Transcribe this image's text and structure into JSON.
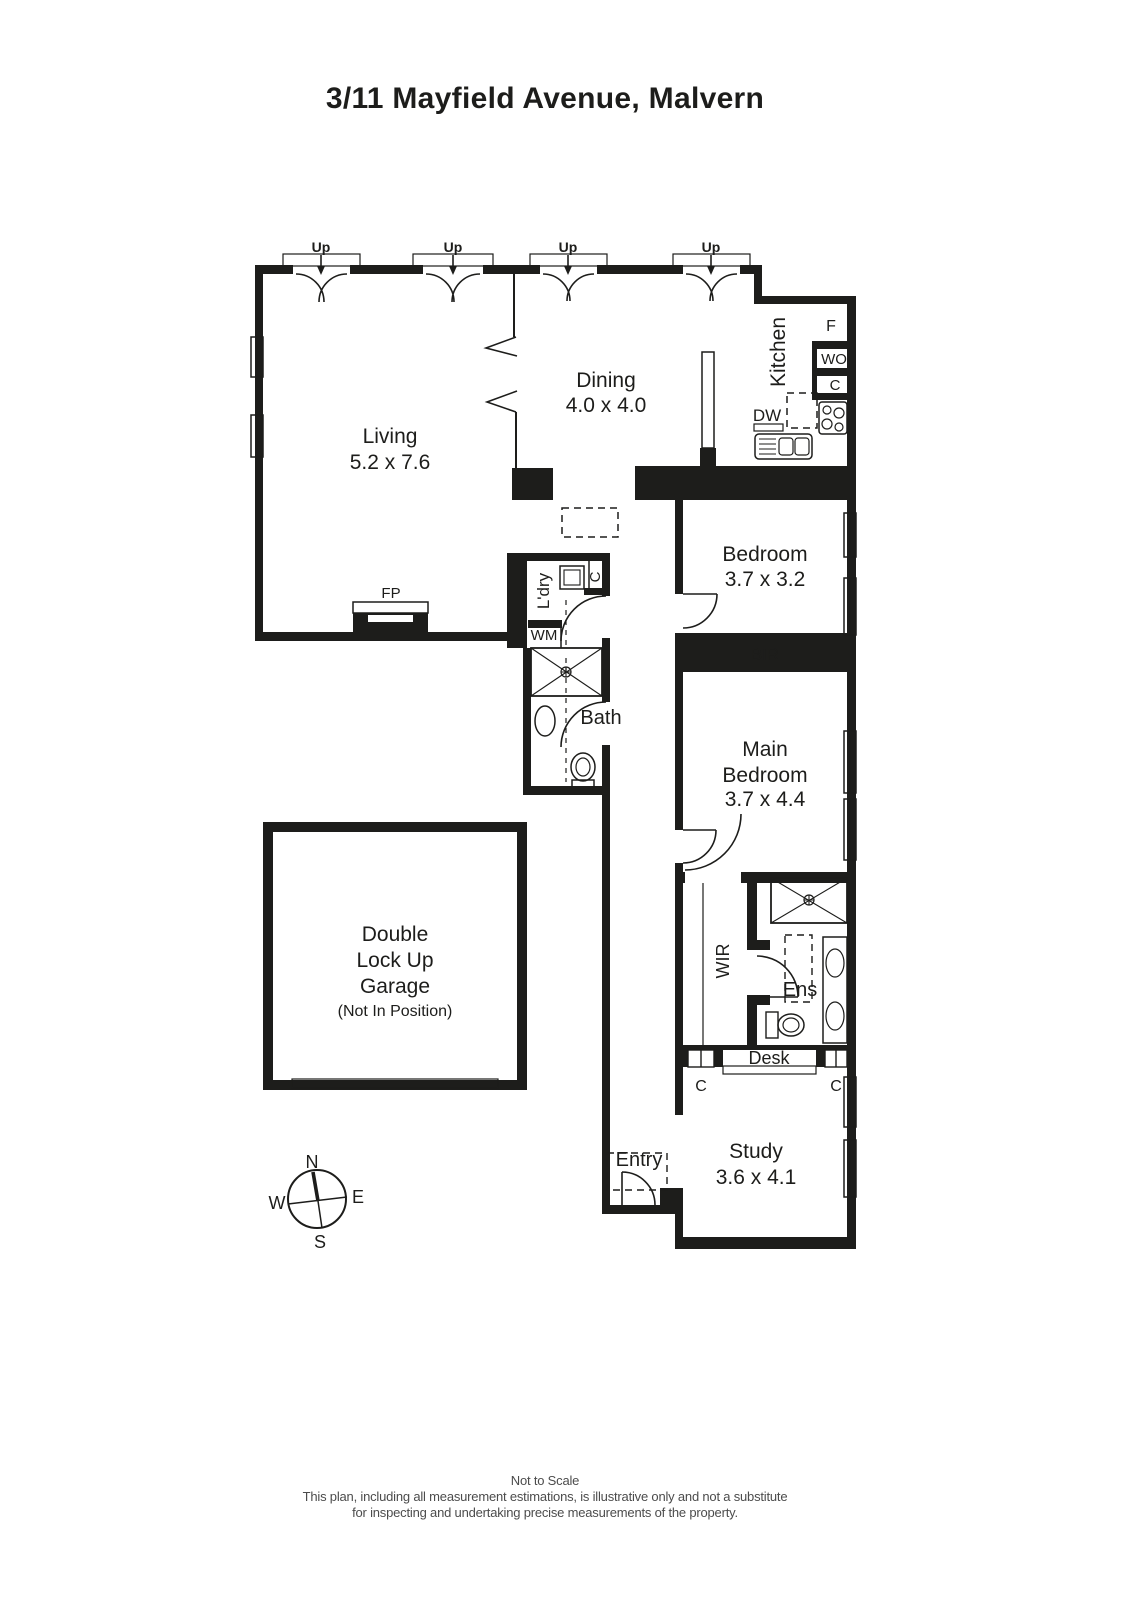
{
  "title": "3/11 Mayfield Avenue, Malvern",
  "labels": {
    "up": "Up",
    "living": "Living",
    "living_dims": "5.2 x 7.6",
    "dining": "Dining",
    "dining_dims": "4.0 x 4.0",
    "kitchen": "Kitchen",
    "fridge": "F",
    "wall_oven": "WO",
    "cupboard": "C",
    "dishwasher": "DW",
    "fireplace": "FP",
    "bedroom": "Bedroom",
    "bedroom_dims": "3.7 x 3.2",
    "bir": "BIR",
    "main_bedroom_line1": "Main",
    "main_bedroom_line2": "Bedroom",
    "main_bedroom_dims": "3.7 x 4.4",
    "laundry": "L'dry",
    "washing_machine": "WM",
    "bath": "Bath",
    "wir": "WIR",
    "ensuite": "Ens",
    "desk": "Desk",
    "study": "Study",
    "study_dims": "3.6 x 4.1",
    "entry": "Entry",
    "garage_line1": "Double",
    "garage_line2": "Lock Up",
    "garage_line3": "Garage",
    "garage_note": "(Not In Position)"
  },
  "compass": {
    "north": "N",
    "east": "E",
    "south": "S",
    "west": "W"
  },
  "footer": {
    "line1": "Not to Scale",
    "line2": "This plan, including all measurement estimations, is illustrative only and not a substitute",
    "line3": "for inspecting and undertaking precise measurements of the property."
  },
  "colors": {
    "wall": "#1d1d1b",
    "text": "#1d1d1b",
    "footer_text": "#4c4c4c",
    "background": "#ffffff"
  }
}
